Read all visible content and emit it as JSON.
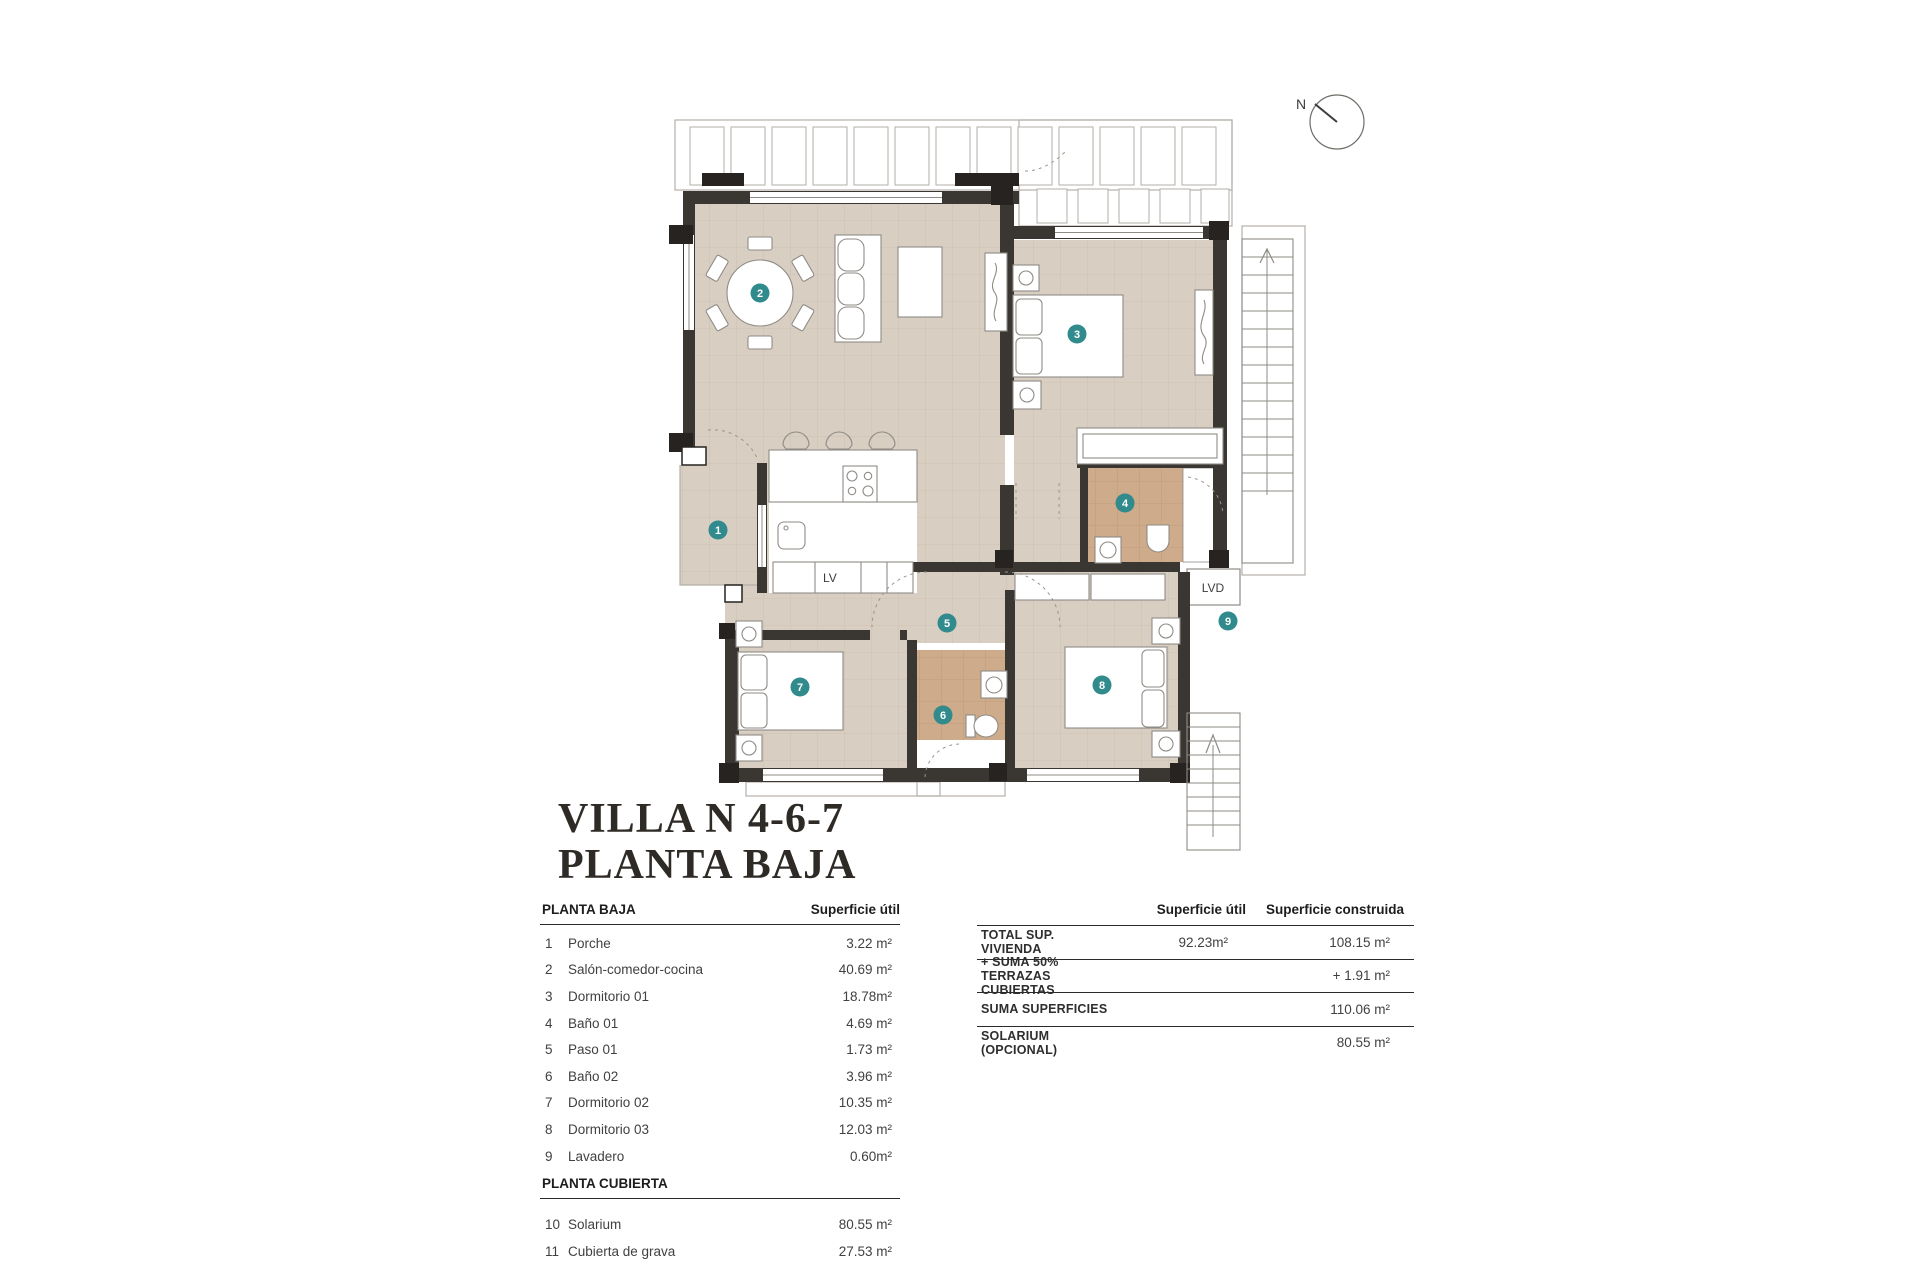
{
  "title": {
    "line1": "VILLA N 4-6-7",
    "line2": "PLANTA BAJA"
  },
  "plan": {
    "north_label": "N",
    "lv_label": "LV",
    "lvd_label": "LVD",
    "badges": [
      "1",
      "2",
      "3",
      "4",
      "5",
      "6",
      "7",
      "8",
      "9"
    ]
  },
  "left_table": {
    "section1_header": "PLANTA BAJA",
    "col_header": "Superficie útil",
    "rows": [
      {
        "num": "1",
        "name": "Porche",
        "value": "3.22 m²"
      },
      {
        "num": "2",
        "name": "Salón-comedor-cocina",
        "value": "40.69 m²"
      },
      {
        "num": "3",
        "name": "Dormitorio 01",
        "value": "18.78m²"
      },
      {
        "num": "4",
        "name": "Baño 01",
        "value": "4.69 m²"
      },
      {
        "num": "5",
        "name": "Paso 01",
        "value": "1.73 m²"
      },
      {
        "num": "6",
        "name": "Baño 02",
        "value": "3.96 m²"
      },
      {
        "num": "7",
        "name": "Dormitorio 02",
        "value": "10.35 m²"
      },
      {
        "num": "8",
        "name": "Dormitorio 03",
        "value": "12.03 m²"
      },
      {
        "num": "9",
        "name": "Lavadero",
        "value": "0.60m²"
      }
    ],
    "section2_header": "PLANTA CUBIERTA",
    "rows2": [
      {
        "num": "10",
        "name": "Solarium",
        "value": "80.55 m²"
      },
      {
        "num": "11",
        "name": "Cubierta de grava",
        "value": "27.53 m²"
      }
    ]
  },
  "right_table": {
    "col1_header": "Superficie útil",
    "col2_header": "Superficie construida",
    "rows": [
      {
        "label": "TOTAL SUP. VIVIENDA",
        "util": "92.23m²",
        "construida": "108.15 m²"
      },
      {
        "label": "+ SUMA 50% TERRAZAS CUBIERTAS",
        "util": "",
        "construida": "+ 1.91 m²"
      },
      {
        "label": "SUMA SUPERFICIES",
        "util": "",
        "construida": "110.06 m²"
      },
      {
        "label": "SOLARIUM (OPCIONAL)",
        "util": "",
        "construida": "80.55 m²"
      }
    ]
  },
  "colors": {
    "accent_teal": "#318a8c",
    "floor_beige": "#d8cec2",
    "floor_tan": "#cdab8b",
    "wall": "#3a3733"
  }
}
